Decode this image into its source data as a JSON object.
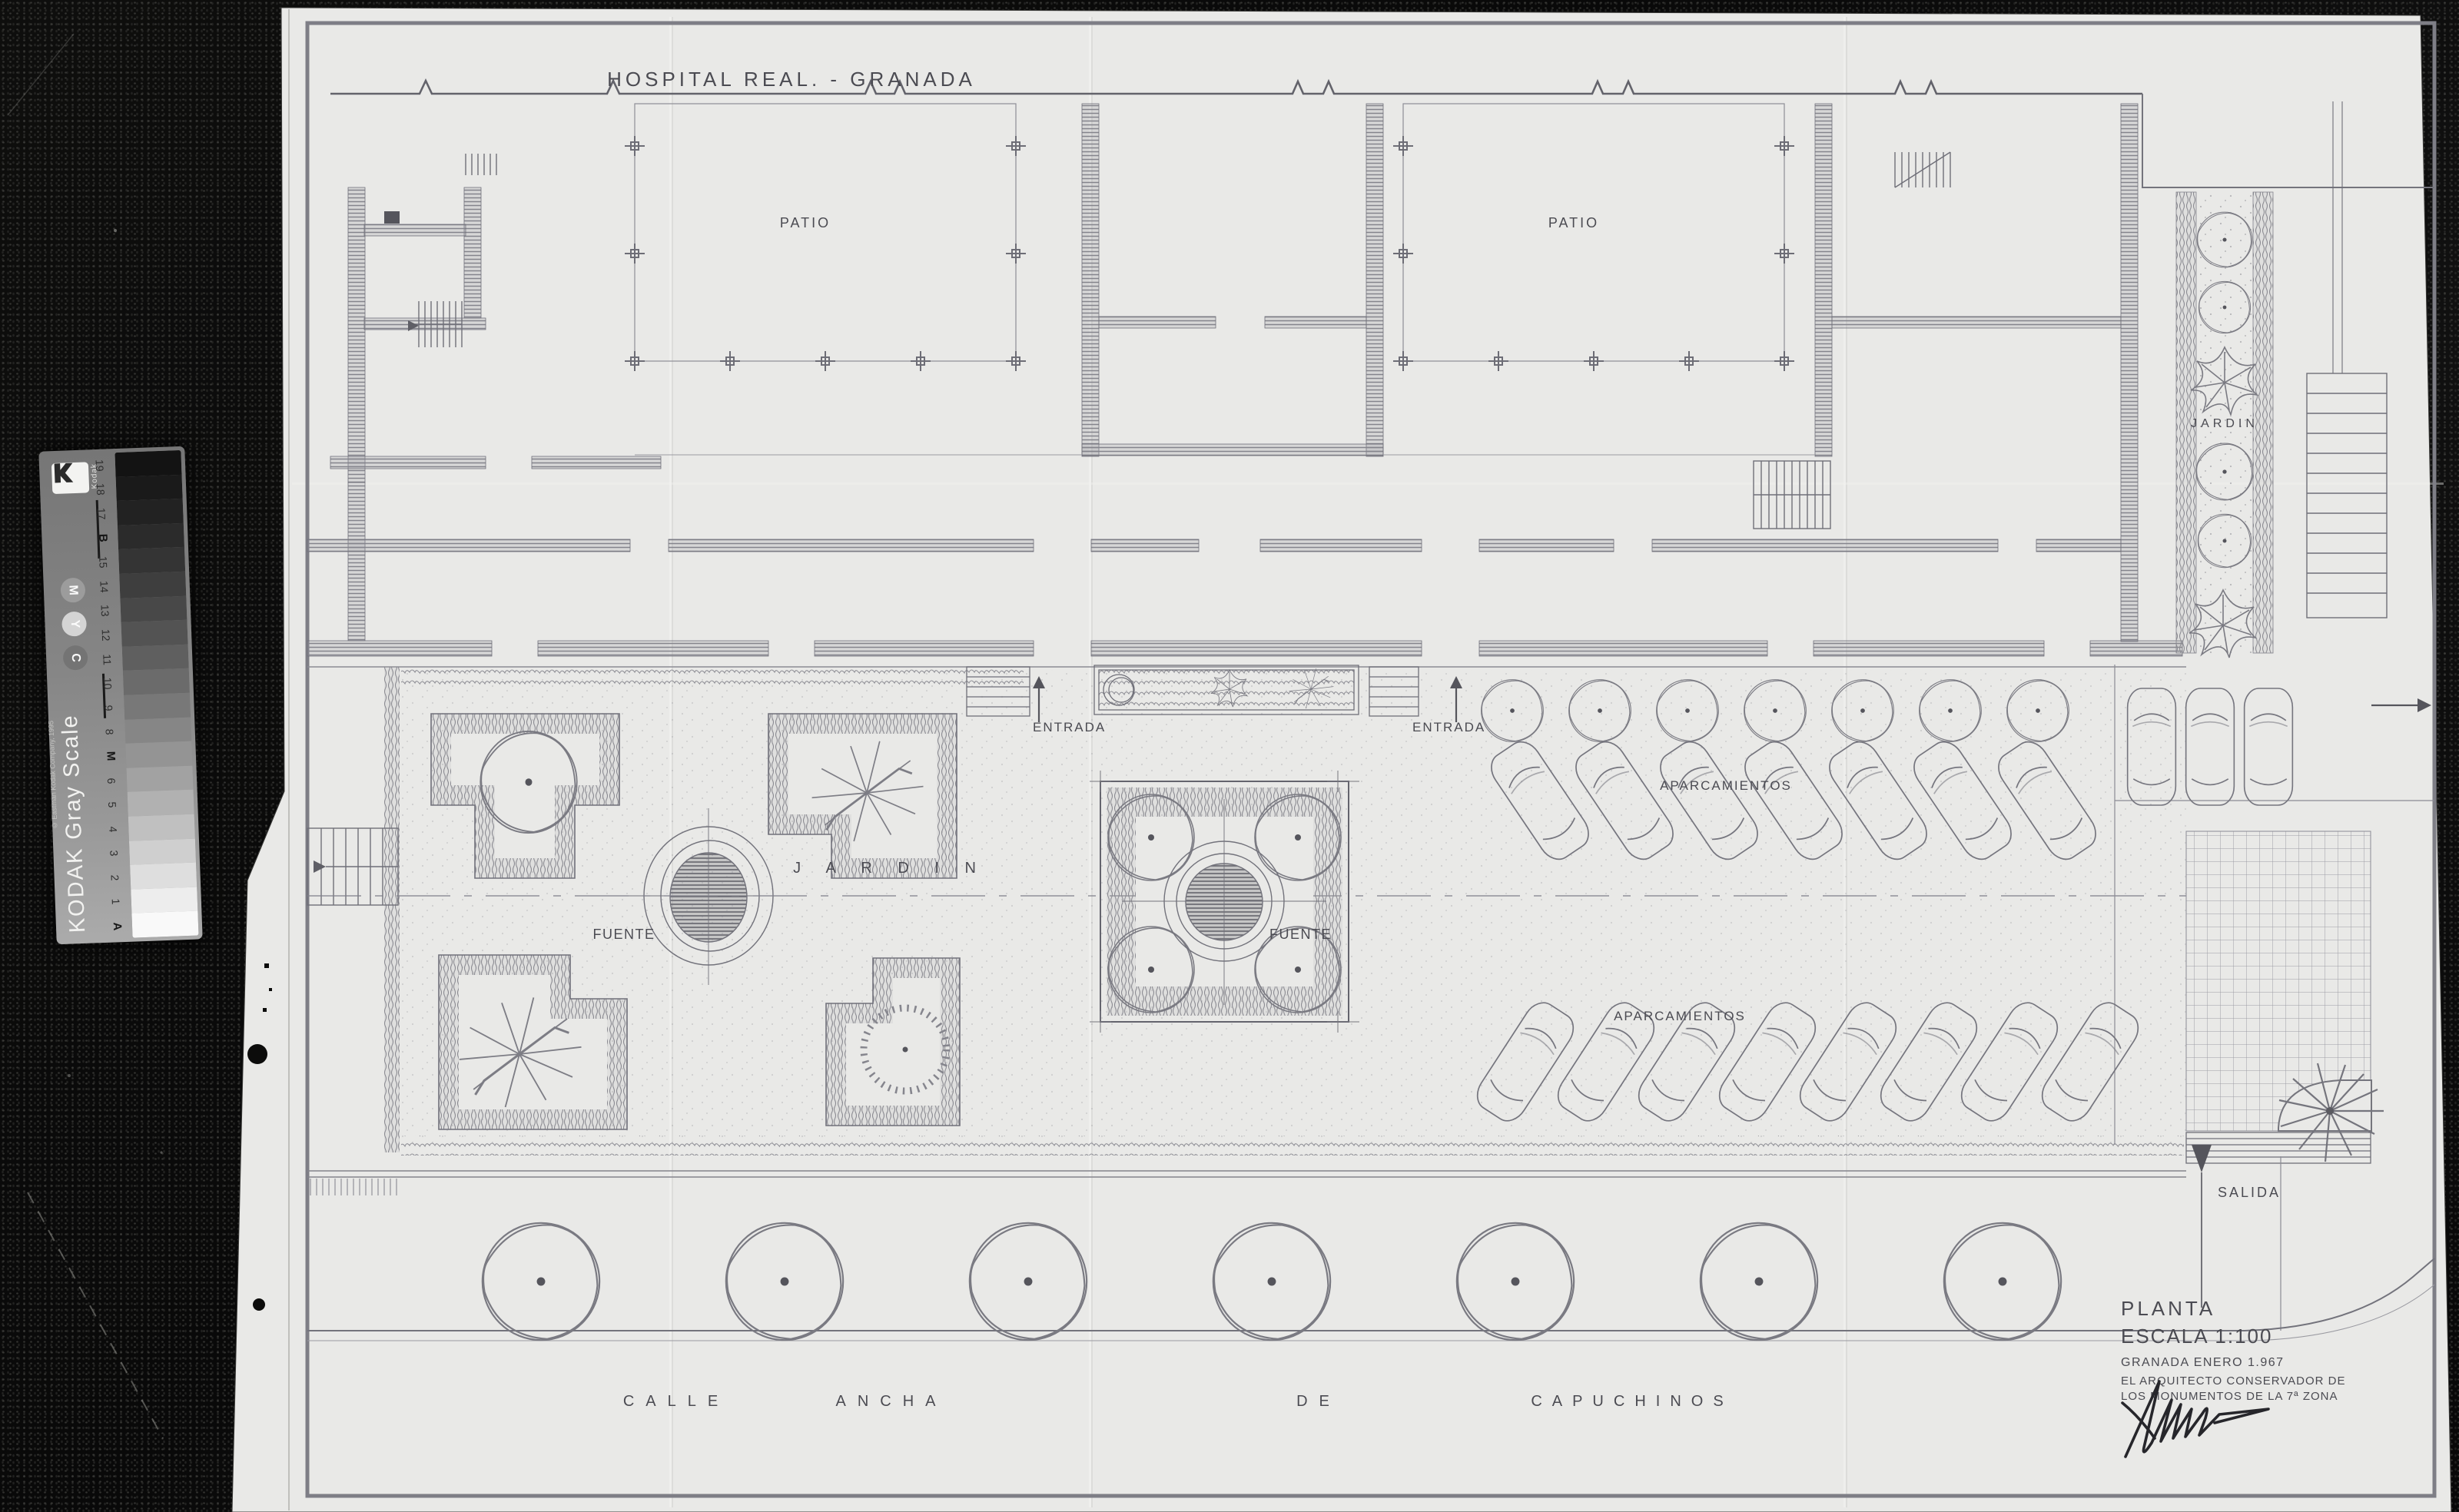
{
  "photo": {
    "background_color": "#0b0b0a",
    "paper_color": "#e9e9e7",
    "ink_color": "#4b4b52",
    "wall_color": "#84848c"
  },
  "plan": {
    "title": "HOSPITAL REAL. - GRANADA",
    "labels": {
      "patio_left": "PATIO",
      "patio_right": "PATIO",
      "jardin_strip": "JARDIN",
      "jardin_main": "J A R D I N",
      "fuente_garden": "FUENTE",
      "fuente_plaza": "FUENTE",
      "entrada_left": "ENTRADA",
      "entrada_right": "ENTRADA",
      "aparcamientos_upper": "APARCAMIENTOS",
      "aparcamientos_lower": "APARCAMIENTOS",
      "salida": "SALIDA"
    },
    "street": {
      "words": [
        "CALLE",
        "ANCHA",
        "DE",
        "CAPUCHINOS"
      ]
    },
    "title_block": {
      "plan_label": "PLANTA",
      "scale_label": "ESCALA 1:100",
      "date_line": "GRANADA ENERO 1.967",
      "architect_line_1": "EL ARQUITECTO CONSERVADOR DE",
      "architect_line_2": "LOS MONUMENTOS DE LA 7ª ZONA"
    }
  },
  "kodak": {
    "product_name": "KODAK Gray Scale",
    "copyright": "© Eastman Kodak Company, 1995",
    "brand": "Kodak",
    "steps_top_to_bottom": [
      {
        "label": "19",
        "color": "#131313",
        "bold": false
      },
      {
        "label": "18",
        "color": "#1a1a1a",
        "bold": false
      },
      {
        "label": "17",
        "color": "#222222",
        "bold": false
      },
      {
        "label": "B",
        "color": "#2b2b2b",
        "bold": true
      },
      {
        "label": "15",
        "color": "#343434",
        "bold": false
      },
      {
        "label": "14",
        "color": "#3e3e3e",
        "bold": false
      },
      {
        "label": "13",
        "color": "#484848",
        "bold": false
      },
      {
        "label": "12",
        "color": "#535353",
        "bold": false
      },
      {
        "label": "11",
        "color": "#5f5f5f",
        "bold": false
      },
      {
        "label": "10",
        "color": "#6b6b6b",
        "bold": false
      },
      {
        "label": "9",
        "color": "#787878",
        "bold": false
      },
      {
        "label": "8",
        "color": "#868686",
        "bold": false
      },
      {
        "label": "M",
        "color": "#949494",
        "bold": true
      },
      {
        "label": "6",
        "color": "#a2a2a2",
        "bold": false
      },
      {
        "label": "5",
        "color": "#b1b1b1",
        "bold": false
      },
      {
        "label": "4",
        "color": "#c0c0c0",
        "bold": false
      },
      {
        "label": "3",
        "color": "#cfcfcf",
        "bold": false
      },
      {
        "label": "2",
        "color": "#dedede",
        "bold": false
      },
      {
        "label": "1",
        "color": "#ededed",
        "bold": false
      },
      {
        "label": "A",
        "color": "#f9f9f9",
        "bold": true
      }
    ],
    "ink_circles_top_to_bottom": [
      {
        "letter": "M",
        "fill": "#9c9c9c"
      },
      {
        "letter": "Y",
        "fill": "#d4d4d4"
      },
      {
        "letter": "C",
        "fill": "#747474"
      }
    ]
  }
}
